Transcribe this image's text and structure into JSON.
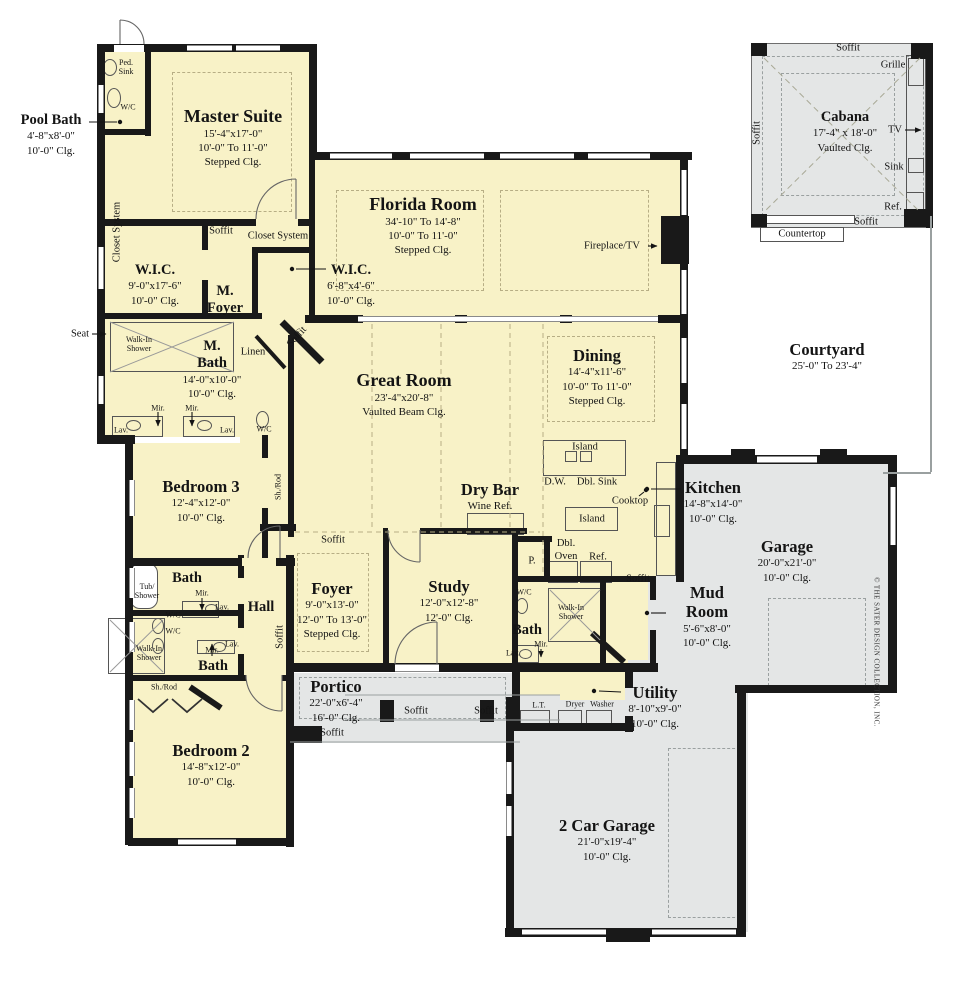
{
  "rooms": {
    "pool_bath": {
      "name": "Pool Bath",
      "line1": "4'-8\"x8'-0\"",
      "line2": "10'-0\"  Clg."
    },
    "master_suite": {
      "name": "Master Suite",
      "line1": "15'-4\"x17'-0\"",
      "line2": "10'-0\" To 11'-0\"",
      "line3": "Stepped Clg."
    },
    "florida_room": {
      "name": "Florida Room",
      "line1": "34'-10\" To 14'-8\"",
      "line2": "10'-0\" To 11'-0\"",
      "line3": "Stepped Clg."
    },
    "wic_left": {
      "name": "W.I.C.",
      "line1": "9'-0\"x17'-6\"",
      "line2": "10'-0\" Clg."
    },
    "wic_right": {
      "name": "W.I.C.",
      "line1": "6'-8\"x4'-6\"",
      "line2": "10'-0\" Clg."
    },
    "m_foyer": {
      "name": "M.",
      "name2": "Foyer"
    },
    "m_bath": {
      "name": "M.",
      "name2": "Bath",
      "line1": "14'-0\"x10'-0\"",
      "line2": "10'-0\" Clg."
    },
    "great_room": {
      "name": "Great Room",
      "line1": "23'-4\"x20'-8\"",
      "line2": "Vaulted Beam Clg."
    },
    "dining": {
      "name": "Dining",
      "line1": "14'-4\"x11'-6\"",
      "line2": "10'-0\" To 11'-0\"",
      "line3": "Stepped Clg."
    },
    "bedroom3": {
      "name": "Bedroom 3",
      "line1": "12'-4\"x12'-0\"",
      "line2": "10'-0\" Clg."
    },
    "dry_bar": {
      "name": "Dry Bar",
      "line1": "Wine Ref."
    },
    "kitchen": {
      "name": "Kitchen",
      "line1": "14'-8\"x14'-0\"",
      "line2": "10'-0\" Clg."
    },
    "garage": {
      "name": "Garage",
      "line1": "20'-0\"x21'-0\"",
      "line2": "10'-0\" Clg."
    },
    "mud_room": {
      "name": "Mud",
      "name2": "Room",
      "line1": "5'-6\"x8'-0\"",
      "line2": "10'-0\" Clg."
    },
    "utility": {
      "name": "Utility",
      "line1": "8'-10\"x9'-0\"",
      "line2": "10'-0\" Clg."
    },
    "study": {
      "name": "Study",
      "line1": "12'-0\"x12'-8\"",
      "line2": "12'-0\" Clg."
    },
    "foyer": {
      "name": "Foyer",
      "line1": "9'-0\"x13'-0\"",
      "line2": "12'-0\" To 13'-0\"",
      "line3": "Stepped Clg."
    },
    "hall": {
      "name": "Hall"
    },
    "bath_hall_upper": {
      "name": "Bath"
    },
    "bath_hall_lower": {
      "name": "Bath"
    },
    "bath_study": {
      "name": "Bath"
    },
    "bedroom2": {
      "name": "Bedroom 2",
      "line1": "14'-8\"x12'-0\"",
      "line2": "10'-0\" Clg."
    },
    "portico": {
      "name": "Portico",
      "line1": "22'-0\"x6'-4\"",
      "line2": "16'-0\" Clg."
    },
    "two_car_garage": {
      "name": "2 Car Garage",
      "line1": "21'-0\"x19'-4\"",
      "line2": "10'-0\" Clg."
    },
    "cabana": {
      "name": "Cabana",
      "line1": "17'-4\" x 18'-0\"",
      "line2": "Vaulted Clg."
    },
    "courtyard": {
      "name": "Courtyard",
      "line1": "25'-0\" To 23'-4\""
    }
  },
  "ann": {
    "soffit": "Soffit",
    "closet_system": "Closet System",
    "island": "Island",
    "linen": "Linen",
    "fireplace_tv": "Fireplace/TV",
    "seat": "Seat",
    "walk_in_shower": "Walk-In\nShower",
    "ped_sink": "Ped.\nSink",
    "tub_shower": "Tub/\nShower",
    "dbl_oven": "Dbl.\nOven",
    "wc": "W/C",
    "lav": "Lav.",
    "mir": "Mir.",
    "sh_rod": "Sh./Rod",
    "dw": "D.W.",
    "dbl_sink": "Dbl. Sink",
    "cooktop": "Cooktop",
    "ref": "Ref.",
    "p": "P.",
    "lt": "L.T.",
    "dryer": "Dryer",
    "washer": "Washer",
    "grille": "Grille",
    "tv": "TV",
    "sink": "Sink",
    "countertop": "Countertop",
    "copyright": "© THE SATER DESIGN COLLECTION, INC."
  },
  "colors": {
    "floor": "#F8F2C7",
    "garage_floor": "#E4E6E6",
    "wall": "#191919",
    "ceiling_dash": "#b7ae85"
  }
}
